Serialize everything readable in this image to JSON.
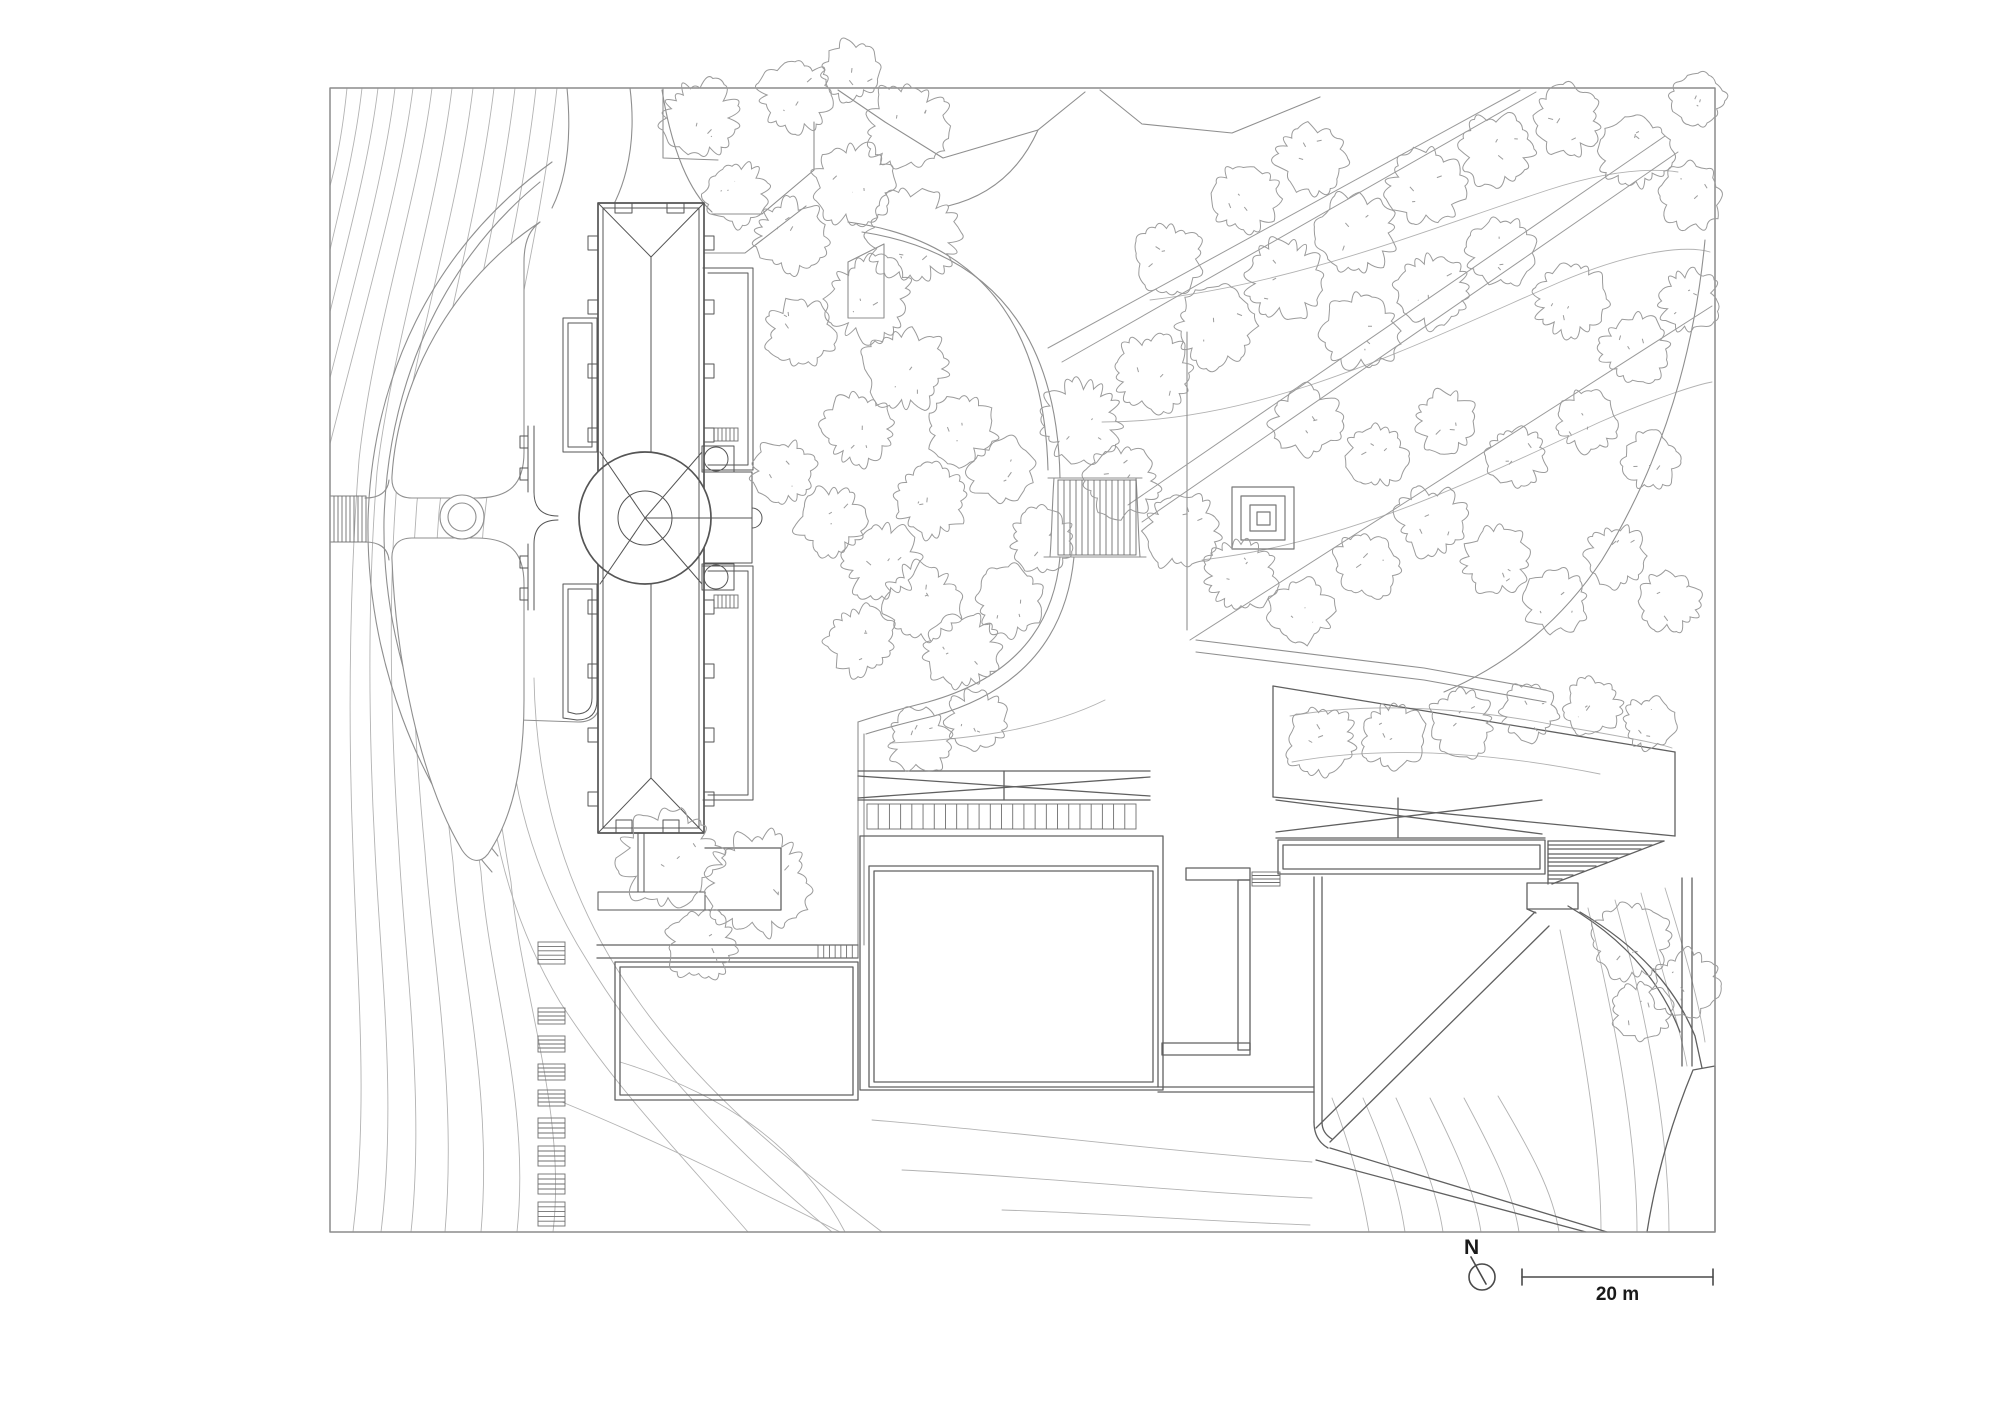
{
  "meta": {
    "drawing_type": "architectural site plan",
    "north_label": "N",
    "scale_label": "20 m"
  },
  "colors": {
    "background": "#ffffff",
    "contour": "#b2b2b2",
    "road": "#8f8f8f",
    "palace": "#555555",
    "modern": "#606060",
    "tree": "#9b9b9b",
    "forest": "#9a9a9a",
    "frame": "#8c8c8c",
    "legend": "#4a4a4a"
  },
  "drawing": {
    "viewbox": "0 0 2000 1414",
    "layers": [
      {
        "name": "contour-lines",
        "stroke": "#b2b2b2",
        "w": 0.9,
        "fill": "none",
        "paths": [
          "M347,88 C342,138 335,168 330,186",
          "M362,88 C355,150 341,202 330,250",
          "M378,88 C369,162 348,238 330,312",
          "M395,88 C385,172 357,272 330,378",
          "M413,88 C401,182 366,302 330,444",
          "M432,88 C418,200 373,330 359,460 C351,562 347,702 353,850 C357,980 369,1102 353,1232",
          "M452,88 C437,210 391,352 377,472 C369,572 367,702 375,850 C381,972 397,1102 381,1232",
          "M473,88 C457,220 409,362 397,482 C389,582 389,702 399,850 C405,962 425,1100 411,1232",
          "M494,88 C477,230 429,382 417,502 C409,602 411,704 425,852 C433,962 457,1092 445,1232",
          "M515,88 C497,240 451,392 439,512 C431,612 435,712 453,862 C461,972 493,1092 481,1232",
          "M536,88 C519,242 473,394 461,522 C453,622 459,722 481,872 C489,982 531,1102 517,1232",
          "M557,88 C539,250 495,402 483,532 C475,632 485,732 511,882 C521,992 567,1112 553,1232",
          "M508,690 C508,790 536,880 588,962 C648,1062 736,1152 832,1232",
          "M484,730 C488,830 512,922 560,1002 C618,1092 688,1162 748,1232",
          "M534,678 C536,798 570,902 632,992 C700,1092 790,1162 882,1232",
          "M620,1062 C718,1092 798,1142 845,1232",
          "M562,1102 C660,1142 760,1192 840,1232",
          "M872,1120 C1000,1130 1150,1150 1312,1162",
          "M902,1170 C1030,1176 1180,1192 1312,1198",
          "M1002,1210 C1100,1213 1200,1221 1310,1225",
          "M1332,1098 C1352,1150 1362,1192 1369,1232",
          "M1363,1098 C1387,1152 1399,1192 1405,1232",
          "M1396,1098 C1421,1152 1437,1192 1443,1232",
          "M1430,1098 C1457,1152 1475,1192 1481,1232",
          "M1464,1098 C1493,1152 1513,1192 1519,1232",
          "M1498,1096 C1531,1152 1553,1192 1559,1232",
          "M1560,930 C1581,1032 1601,1142 1601,1232",
          "M1588,908 C1613,1012 1637,1132 1637,1232",
          "M1615,900 C1643,1002 1669,1122 1669,1232",
          "M1641,893 C1665,982 1681,1032 1687,1066",
          "M1665,888 C1685,952 1699,1002 1705,1042",
          "M1290,716 C1380,700 1480,710 1560,726 C1620,736 1662,744 1672,748",
          "M1292,762 C1390,744 1500,754 1600,774",
          "M1150,300 C1300,282 1420,232 1548,190 C1610,170 1650,168 1678,172",
          "M1102,422 C1260,422 1400,352 1560,282 C1640,248 1690,246 1710,252",
          "M1202,560 C1350,542 1470,482 1600,422 C1660,396 1700,384 1712,382",
          "M890,743 C960,740 1040,732 1105,700"
        ]
      },
      {
        "name": "roads-paths",
        "stroke": "#8f8f8f",
        "w": 1.1,
        "fill": "none",
        "paths": [
          "M567,88 C572,140 566,180 552,208",
          "M630,88 C638,152 622,198 600,226",
          "M662,90 C672,152 690,192 712,212",
          "M552,162 C430,250 372,380 368,520 C366,660 420,790 492,872",
          "M540,182 C440,264 388,386 384,520 C382,650 432,776 498,856",
          "M600,660 L600,700 Q600,722 578,722 L520,720",
          "M838,90 L885,122 L943,158 L1038,130 L1085,92",
          "M1100,90 L1142,124 L1232,133 L1320,97",
          "M1038,130 C1020,170 990,196 948,206",
          "M663,89 V158 L718,160",
          "M712,214 L762,214 L814,170 L814,122",
          "M848,262 L884,244 V318 H848 Z",
          "M690,253 L745,253 L806,206",
          "M365,498 Q387,498 389,480",
          "M365,542 Q387,542 389,560"
        ]
      },
      {
        "name": "lawn-parterres",
        "stroke": "#8f8f8f",
        "w": 1.1,
        "fill": "#ffffff",
        "paths": [
          "M540,222 C452,280 398,380 392,476 C391,490 398,498 412,498 L476,498 C510,498 524,484 524,452 L524,262 C524,238 532,228 540,222 Z",
          "M412,538 L476,538 C510,538 524,552 524,584 L524,700 C524,772 510,822 488,854 C480,864 470,862 462,850 C420,780 396,660 392,560 C391,546 398,538 412,538 Z"
        ]
      },
      {
        "name": "central-court",
        "stroke": "#8f8f8f",
        "w": 1.1,
        "fill": "none",
        "paths": [
          "M862,232 Q1056,262 1060,478",
          "M848,222 Q1042,248 1048,470",
          "M1060,557 Q1050,668 928,702 Q888,712 858,722",
          "M1074,557 Q1062,680 934,716 Q892,726 866,734",
          "M858,722 V958",
          "M864,734 V945",
          "M1196,640 L1424,668 L1546,690",
          "M1196,652 L1424,680 L1546,702",
          "M1187,332 V630",
          "M1705,240 Q1688,420 1602,560 Q1542,650 1444,692",
          "M1054,478 C1052,506 1052,532 1050,557",
          "M1136,478 C1138,506 1138,532 1140,557",
          "M1048,478 H1142",
          "M1044,557 H1146"
        ]
      },
      {
        "name": "forest-allees",
        "stroke": "#9a9a9a",
        "w": 1.0,
        "fill": "none",
        "paths": [
          "M1048,348 L1520,90",
          "M1062,362 L1536,92",
          "M1128,505 L1665,136",
          "M1142,522 L1678,152",
          "M1190,640 L1712,306"
        ]
      },
      {
        "name": "square-monument",
        "stroke": "#777777",
        "w": 1.2,
        "fill": "none",
        "paths": [
          "M1232,487 h62 v62 h-62 Z",
          "M1241,496 h44 v44 h-44 Z",
          "M1250,505 h26 v26 h-26 Z",
          "M1257,512 h13 v13 h-13 Z"
        ]
      },
      {
        "name": "modern-buildings",
        "stroke": "#606060",
        "w": 1.3,
        "fill": "none",
        "paths": [
          "M860,836 V1090 H1163 V836 Z",
          "M869,866 H1158 V1087 H869 Z",
          "M874,871 H1153 V1082 H874 Z",
          "M858,771 H1150",
          "M858,798 L1150,777",
          "M858,776 L1150,796",
          "M1004,771 V800",
          "M858,800 H1150",
          "M597,945 H858",
          "M597,958 H858",
          "M615,962 H858 V1100 H615 Z",
          "M620,967 H853 V1095 H620 Z",
          "M705,848 H781 V910 H705",
          "M1186,868 h64 v12 h-64 Z",
          "M1238,880 h12 v170 h-12 Z",
          "M1162,1043 h88 v12 h-88 Z",
          "M1158,1087 H1314",
          "M1158,1092 H1314",
          "M1314,877 V1122",
          "M1322,877 V1122",
          "M1314,1122 Q1314,1140 1328,1148",
          "M1322,1122 Q1322,1133 1332,1139",
          "M1273,686 L1675,752",
          "M1273,797 L1675,836",
          "M1273,686 V797",
          "M1675,752 V836",
          "M1276,800 L1542,834",
          "M1276,832 L1542,800",
          "M1398,798 V837",
          "M1276,838 H1545",
          "M1278,840 H1545 V874 H1278 Z",
          "M1283,845 H1540 V869 H1283 Z",
          "M1548,841 H1664",
          "M1548,845 H1652",
          "M1548,849 H1641",
          "M1548,854 H1630",
          "M1548,858 H1618",
          "M1548,862 H1607",
          "M1548,866 H1596",
          "M1548,871 H1584",
          "M1548,875 H1573",
          "M1548,879 H1562",
          "M1664,841 L1552,884",
          "M1548,841 V884",
          "M1527,883 h51 v26 h-51 Z",
          "M1535,912 L1316,1128",
          "M1549,926 L1330,1142",
          "M1330,1148 L1607,1232",
          "M1316,1160 L1586,1232",
          "M1527,909 L1536,913",
          "M1580,912 Q1665,962 1695,1036 L1702,1068",
          "M1568,906 Q1650,954 1680,1032",
          "M1682,878 V1066",
          "M1692,878 V1066",
          "M1693,1070 L1715,1066 V1232 H1647 Q1660,1150 1693,1070 Z"
        ]
      },
      {
        "name": "palace-body",
        "stroke": "#555555",
        "w": 1.7,
        "fill": "#ffffff",
        "paths": [
          "M598,203 H704 V833 H598 Z"
        ]
      },
      {
        "name": "palace-detail",
        "stroke": "#555555",
        "w": 1.0,
        "fill": "none",
        "paths": [
          "M603,208 H699 V828 H603 Z",
          "M598,203 L651,257 L704,203",
          "M651,257 V452",
          "M651,584 V778",
          "M598,833 L651,778 L704,833",
          "M600,452 L645,518",
          "M600,584 L645,518",
          "M702,452 L645,518",
          "M702,584 L645,518",
          "M704,472 H752 V563 H704",
          "M645,518 H752",
          "M752,508 A10 10 0 0 1 752,528",
          "M563,318 H597 V452 H563 Z",
          "M568,323 H592 V447 H568 Z",
          "M563,584 H597 V700 Q597,720 577,720 L563,718 Z",
          "M568,589 H592 V698 Q592,714 576,714 L568,712 Z",
          "M703,268 H753 V470 H703",
          "M708,273 H748 V465 H708",
          "M703,566 H753 V800 H703",
          "M708,571 H748 V795 H708",
          "M528,426 V492",
          "M534,426 V492",
          "M528,544 V610",
          "M534,544 V610",
          "M534,492 Q534,516 558,516",
          "M534,544 Q534,520 558,520",
          "M588,236 h10 v14 h-10 Z",
          "M588,300 h10 v14 h-10 Z",
          "M588,364 h10 v14 h-10 Z",
          "M588,428 h10 v14 h-10 Z",
          "M588,600 h10 v14 h-10 Z",
          "M588,664 h10 v14 h-10 Z",
          "M588,728 h10 v14 h-10 Z",
          "M588,792 h10 v14 h-10 Z",
          "M704,236 h10 v14 h-10 Z",
          "M704,300 h10 v14 h-10 Z",
          "M704,364 h10 v14 h-10 Z",
          "M704,428 h10 v14 h-10 Z",
          "M704,600 h10 v14 h-10 Z",
          "M704,664 h10 v14 h-10 Z",
          "M704,728 h10 v14 h-10 Z",
          "M704,792 h10 v14 h-10 Z",
          "M615,203 h17 v10 h-17 Z",
          "M667,203 h17 v10 h-17 Z",
          "M616,820 h16 v13 h-16 Z",
          "M663,820 h16 v13 h-16 Z",
          "M520,436 h8 v12 h-8 Z",
          "M520,468 h8 v12 h-8 Z",
          "M520,556 h8 v12 h-8 Z",
          "M520,588 h8 v12 h-8 Z",
          "M702,446 h32 v26 h-32 Z",
          "M702,564 h32 v26 h-32 Z",
          "M638,833 V892",
          "M644,833 V892",
          "M598,892 H705 V910 H598 Z"
        ]
      },
      {
        "name": "plan-frame",
        "stroke": "#8c8c8c",
        "w": 1.5,
        "fill": "none",
        "paths": [
          "M330,88 H1715 V1232 H330 Z"
        ]
      },
      {
        "name": "legend-marks",
        "stroke": "#4a4a4a",
        "w": 1.6,
        "fill": "none",
        "paths": [
          "M1471,1257 L1486,1284",
          "M1522,1277 H1713",
          "M1522,1269 V1285",
          "M1713,1269 V1285"
        ]
      }
    ],
    "hatches": [
      {
        "x": 538,
        "y": 942,
        "w": 27,
        "h": 22,
        "n": 4,
        "dir": "h"
      },
      {
        "x": 538,
        "y": 1008,
        "w": 27,
        "h": 16,
        "n": 3,
        "dir": "h"
      },
      {
        "x": 538,
        "y": 1036,
        "w": 27,
        "h": 16,
        "n": 3,
        "dir": "h"
      },
      {
        "x": 538,
        "y": 1064,
        "w": 27,
        "h": 16,
        "n": 3,
        "dir": "h"
      },
      {
        "x": 538,
        "y": 1090,
        "w": 27,
        "h": 16,
        "n": 3,
        "dir": "h"
      },
      {
        "x": 538,
        "y": 1118,
        "w": 27,
        "h": 20,
        "n": 3,
        "dir": "h"
      },
      {
        "x": 538,
        "y": 1146,
        "w": 27,
        "h": 20,
        "n": 3,
        "dir": "h"
      },
      {
        "x": 538,
        "y": 1174,
        "w": 27,
        "h": 20,
        "n": 3,
        "dir": "h"
      },
      {
        "x": 538,
        "y": 1202,
        "w": 27,
        "h": 24,
        "n": 4,
        "dir": "h"
      },
      {
        "x": 330,
        "y": 496,
        "w": 36,
        "h": 46,
        "n": 8,
        "dir": "v"
      },
      {
        "x": 714,
        "y": 428,
        "w": 24,
        "h": 13,
        "n": 5,
        "dir": "v"
      },
      {
        "x": 714,
        "y": 595,
        "w": 24,
        "h": 13,
        "n": 5,
        "dir": "v"
      },
      {
        "x": 818,
        "y": 945,
        "w": 40,
        "h": 13,
        "n": 6,
        "dir": "v"
      },
      {
        "x": 867,
        "y": 804,
        "w": 269,
        "h": 25,
        "n": 23,
        "dir": "v"
      },
      {
        "x": 1058,
        "y": 480,
        "w": 78,
        "h": 75,
        "n": 12,
        "dir": "v"
      },
      {
        "x": 1252,
        "y": 872,
        "w": 28,
        "h": 14,
        "n": 3,
        "dir": "h"
      }
    ],
    "circles": [
      {
        "cx": 645,
        "cy": 518,
        "r": 66,
        "stroke": "#555555",
        "w": 1.7,
        "fill": "#ffffff"
      },
      {
        "cx": 645,
        "cy": 518,
        "r": 27,
        "stroke": "#555555",
        "w": 1.0,
        "fill": "none"
      },
      {
        "cx": 462,
        "cy": 517,
        "r": 22,
        "stroke": "#8f8f8f",
        "w": 1.1,
        "fill": "#ffffff"
      },
      {
        "cx": 462,
        "cy": 517,
        "r": 14,
        "stroke": "#8f8f8f",
        "w": 1.1,
        "fill": "none"
      },
      {
        "cx": 716,
        "cy": 459,
        "r": 12,
        "stroke": "#555555",
        "w": 1.0,
        "fill": "none"
      },
      {
        "cx": 716,
        "cy": 577,
        "r": 12,
        "stroke": "#555555",
        "w": 1.0,
        "fill": "none"
      },
      {
        "cx": 1482,
        "cy": 1277,
        "r": 13,
        "stroke": "#4a4a4a",
        "w": 1.6,
        "fill": "none"
      }
    ],
    "trees": [
      [
        700,
        118,
        40
      ],
      [
        737,
        194,
        34
      ],
      [
        795,
        95,
        38
      ],
      [
        852,
        70,
        32
      ],
      [
        906,
        126,
        44
      ],
      [
        853,
        183,
        42
      ],
      [
        790,
        236,
        38
      ],
      [
        913,
        233,
        48
      ],
      [
        869,
        299,
        44
      ],
      [
        801,
        333,
        36
      ],
      [
        906,
        369,
        44
      ],
      [
        859,
        429,
        38
      ],
      [
        784,
        471,
        33
      ],
      [
        831,
        521,
        36
      ],
      [
        882,
        561,
        40
      ],
      [
        932,
        501,
        38
      ],
      [
        962,
        431,
        36
      ],
      [
        921,
        601,
        40
      ],
      [
        861,
        641,
        36
      ],
      [
        962,
        651,
        38
      ],
      [
        1011,
        601,
        36
      ],
      [
        1042,
        541,
        34
      ],
      [
        1001,
        471,
        34
      ],
      [
        920,
        741,
        34
      ],
      [
        976,
        721,
        32
      ],
      [
        1081,
        421,
        42
      ],
      [
        1151,
        373,
        40
      ],
      [
        1216,
        326,
        42
      ],
      [
        1286,
        279,
        42
      ],
      [
        1356,
        233,
        42
      ],
      [
        1426,
        186,
        40
      ],
      [
        1496,
        149,
        38
      ],
      [
        1566,
        121,
        36
      ],
      [
        1636,
        151,
        38
      ],
      [
        1691,
        196,
        34
      ],
      [
        1246,
        199,
        36
      ],
      [
        1311,
        159,
        36
      ],
      [
        1169,
        259,
        36
      ],
      [
        1361,
        331,
        40
      ],
      [
        1433,
        291,
        38
      ],
      [
        1503,
        253,
        36
      ],
      [
        1571,
        299,
        40
      ],
      [
        1635,
        349,
        36
      ],
      [
        1689,
        301,
        32
      ],
      [
        1121,
        481,
        38
      ],
      [
        1181,
        531,
        40
      ],
      [
        1241,
        576,
        38
      ],
      [
        1301,
        611,
        34
      ],
      [
        1366,
        566,
        34
      ],
      [
        1431,
        521,
        36
      ],
      [
        1496,
        561,
        36
      ],
      [
        1556,
        601,
        34
      ],
      [
        1616,
        556,
        32
      ],
      [
        1671,
        601,
        32
      ],
      [
        1306,
        421,
        36
      ],
      [
        1376,
        456,
        32
      ],
      [
        1446,
        421,
        32
      ],
      [
        1516,
        456,
        32
      ],
      [
        1586,
        421,
        32
      ],
      [
        1651,
        461,
        30
      ],
      [
        1698,
        101,
        28
      ],
      [
        1321,
        741,
        36
      ],
      [
        1393,
        736,
        34
      ],
      [
        1461,
        723,
        34
      ],
      [
        1529,
        713,
        30
      ],
      [
        1593,
        707,
        30
      ],
      [
        1649,
        723,
        28
      ],
      [
        1632,
        941,
        40
      ],
      [
        1686,
        986,
        36
      ],
      [
        1642,
        1011,
        30
      ],
      [
        668,
        858,
        52
      ],
      [
        757,
        883,
        56
      ],
      [
        701,
        946,
        36
      ]
    ],
    "tree_style": {
      "stroke": "#9b9b9b",
      "w": 1.0
    }
  }
}
